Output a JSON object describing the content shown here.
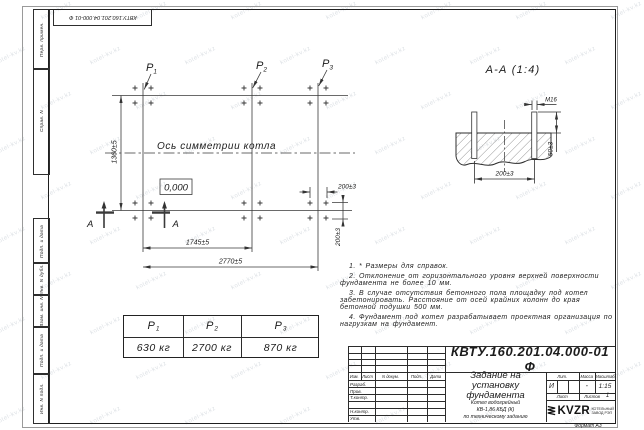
{
  "watermark": {
    "text": "kotel-kv.kz"
  },
  "frame": {
    "strip": [
      "Перв. примен.",
      "Справ. N",
      "Подп. и дата",
      "Инв. N дубл.",
      "Взам. инв. N",
      "Подп. и дата",
      "Инв. N подл."
    ],
    "format_note": "Формат А3"
  },
  "plan": {
    "axis_label": "Ось симметрии котла",
    "level_mark": "0,000",
    "section_letter": "А",
    "dims": {
      "height": "1360±5",
      "inner_span": "1745±5",
      "outer_span": "2770±5",
      "bolt_h": "200±3",
      "bolt_v": "200±3"
    }
  },
  "section": {
    "title": "А-А (1:4)",
    "thread": "М16",
    "bolt_spacing": "200±3",
    "protrusion": "50±3"
  },
  "loads": {
    "p1": {
      "label": "P",
      "sub": "1",
      "value": "630 кг"
    },
    "p2": {
      "label": "P",
      "sub": "2",
      "value": "2700 кг"
    },
    "p3": {
      "label": "P",
      "sub": "3",
      "value": "870 кг"
    }
  },
  "notes": {
    "n1": "1. * Размеры для справок.",
    "n2": "2. Отклонение от горизонтального уровня верхней поверхности фундамента не более 10 мм.",
    "n3": "3. В случае отсутствия бетонного пола площадку под котел забетонировать. Расстояние от осей крайних колонн до края бетонной подушки 500 мм.",
    "n4": "4. Фундамент под котел разрабатывает проектная организация по нагрузкам на фундамент."
  },
  "title_block": {
    "doc_number": "КВТУ.160.201.04.000-01  Ф",
    "doc_title": "Задание на\nустановку\nфундамента",
    "product": "Котел водогрейный\nКВ-1,86 КБД (К)\nпо техническому заданию",
    "rev_headers": {
      "izm": "Изм.",
      "list": "Лист",
      "doc": "N докум.",
      "sign": "Подп.",
      "date": "Дата"
    },
    "roles": {
      "r1": "Разраб.",
      "r2": "Пров.",
      "r3": "Т.контр.",
      "r4": "Н.контр.",
      "r5": "Утв."
    },
    "lit": {
      "header": "Лит.",
      "value": "И"
    },
    "mass": {
      "header": "Масса",
      "value": "-"
    },
    "scale": {
      "header": "Масштаб",
      "value": "1:15"
    },
    "sheet": {
      "label": "Лист",
      "total_label": "Листов",
      "total_value": "1"
    },
    "logo": {
      "name": "KVZR",
      "sub1": "КОТЕЛЬНЫЙ",
      "sub2": "ЗАВОД РЭП"
    }
  }
}
